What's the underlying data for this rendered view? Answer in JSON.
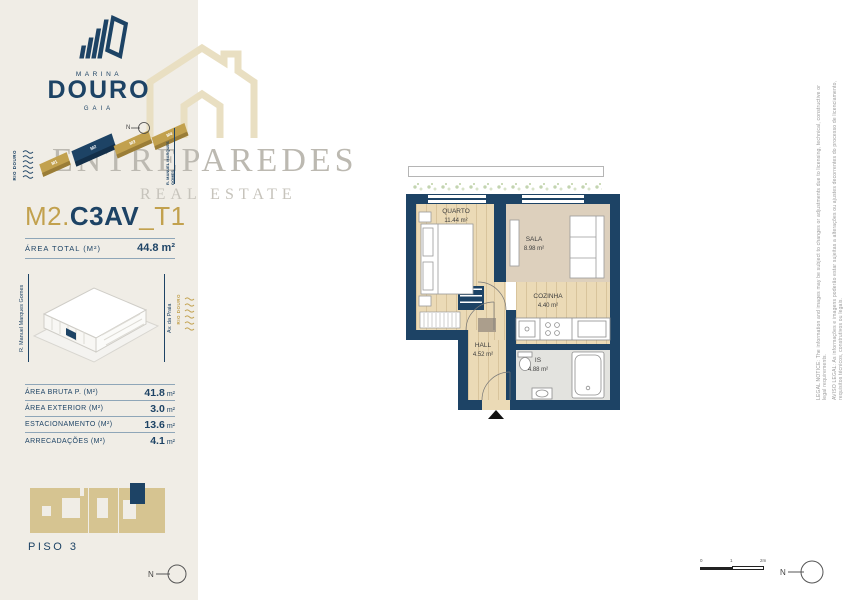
{
  "brand": {
    "marina": "MARINA",
    "douro": "DOURO",
    "gaia": "GAIA"
  },
  "watermark": {
    "name": "ENTREPAREDES",
    "subtitle": "REAL ESTATE"
  },
  "sitemap": {
    "river": "RIO DOURO",
    "street": "R. MANUEL MARQUES GOMES",
    "compass": "N",
    "blocks": [
      "M1",
      "M2",
      "M3",
      "M4"
    ]
  },
  "unit": {
    "prefix": "M2.",
    "code": "C3AV",
    "suffix": "_T1"
  },
  "area_total": {
    "label": "ÁREA TOTAL  (M²)",
    "value": "44.8 m²"
  },
  "location": {
    "street_left": "R. Manuel Marques Gomes",
    "street_right": "Av. da Praia",
    "river": "RIO DOURO"
  },
  "areas": [
    {
      "label": "ÁREA BRUTA P.  (M²)",
      "value": "41.8",
      "unit": "m²"
    },
    {
      "label": "ÁREA EXTERIOR (M²)",
      "value": "3.0",
      "unit": "m²"
    },
    {
      "label": "ESTACIONAMENTO (M²)",
      "value": "13.6",
      "unit": "m²"
    },
    {
      "label": "ARRECADAÇÕES (M²)",
      "value": "4.1",
      "unit": "m²"
    }
  ],
  "floor_label": "PISO 3",
  "plan": {
    "rooms": {
      "quarto": {
        "name": "QUARTO",
        "area": "11.44 m²"
      },
      "sala": {
        "name": "SALA",
        "area": "8.98 m²"
      },
      "cozinha": {
        "name": "COZINHA",
        "area": "4.40 m²"
      },
      "hall": {
        "name": "HALL",
        "area": "4.52 m²"
      },
      "is": {
        "name": "IS",
        "area": "4.88 m²"
      }
    }
  },
  "scalebar": {
    "t0": "0",
    "t1": "1",
    "t2": "2m"
  },
  "compass": {
    "label": "N"
  },
  "legal": {
    "pt": "AVISO LEGAL: As informações e imagens poderão estar sujeitas a alterações ou ajustes decorrentes do processo de licenciamento, requisitos técnicos, construtivos ou legais.",
    "en": "LEGAL NOTICE: The information and images may be subject to changes or adjustments due to licensing, technical, constructive or legal requirements."
  },
  "colors": {
    "navy": "#1d4365",
    "gold": "#c2a14e",
    "cream": "#f0ede6",
    "wood": "#ebdab6",
    "sala_floor": "#ddd0bd",
    "is_floor": "#e3e3df",
    "plate": "#d6c491"
  }
}
